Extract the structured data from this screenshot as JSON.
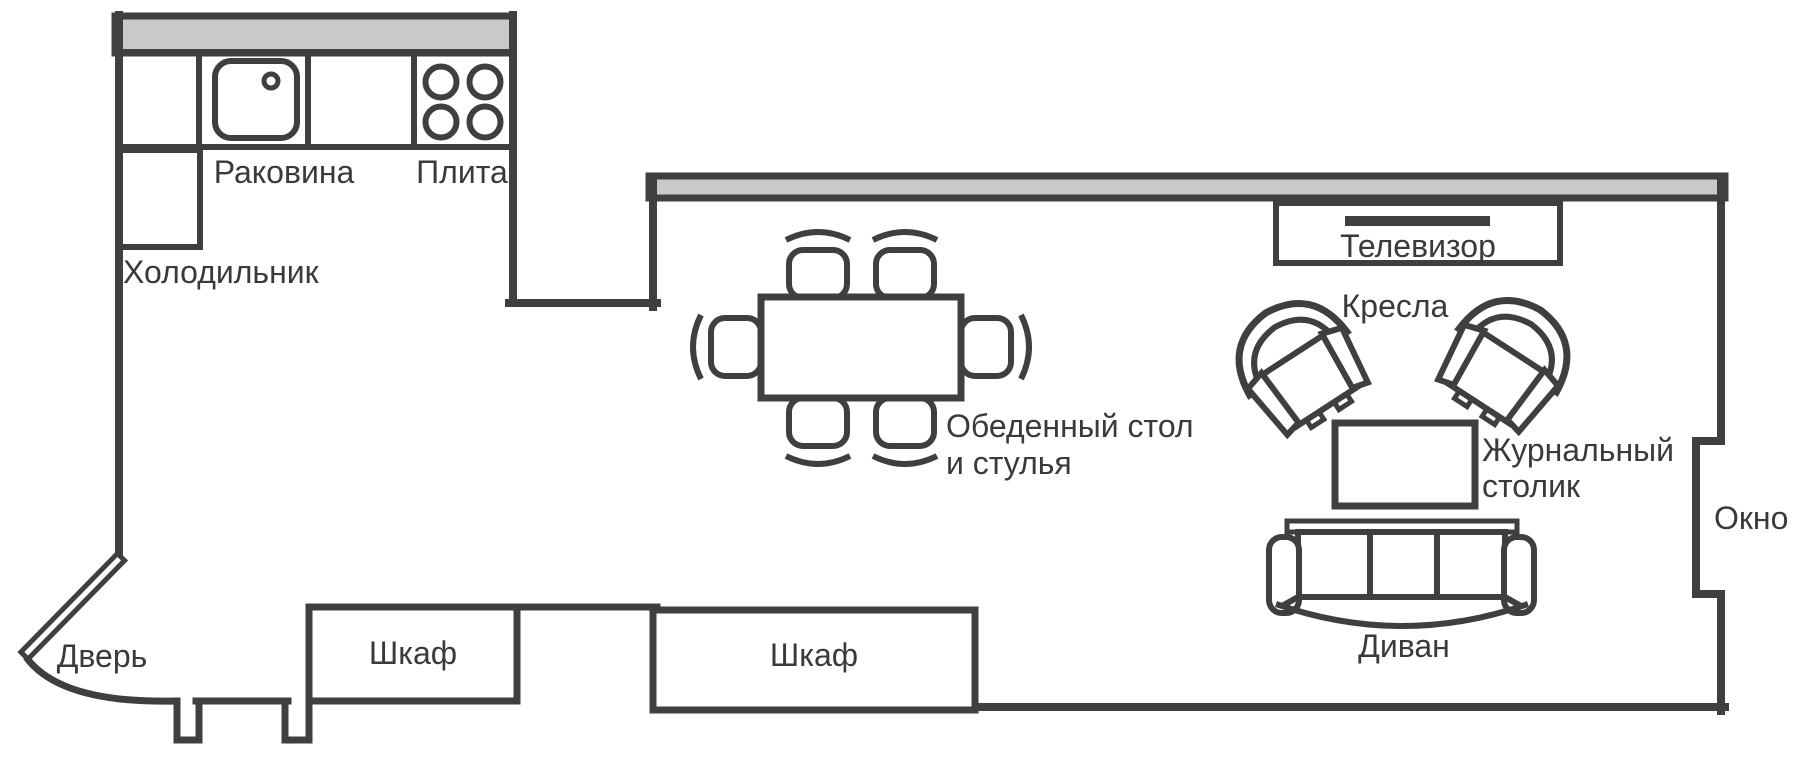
{
  "diagram_type": "apartment-floor-plan",
  "colors": {
    "line": "#3f3f3f",
    "window_band_fill": "#c9c9c9",
    "background": "#ffffff",
    "text": "#3a3a3a"
  },
  "kitchen": {
    "sink_label": "Раковина",
    "stove_label": "Плита",
    "fridge_label": "Холодильник"
  },
  "entry": {
    "door_label": "Дверь"
  },
  "storage": {
    "cabinet1_label": "Шкаф",
    "cabinet2_label": "Шкаф"
  },
  "dining": {
    "label_line1": "Обеденный стол",
    "label_line2": "и стулья"
  },
  "living": {
    "tv_label": "Телевизор",
    "armchairs_label": "Кресла",
    "coffee_table_label_line1": "Журнальный",
    "coffee_table_label_line2": "столик",
    "sofa_label": "Диван",
    "window_label": "Окно"
  }
}
